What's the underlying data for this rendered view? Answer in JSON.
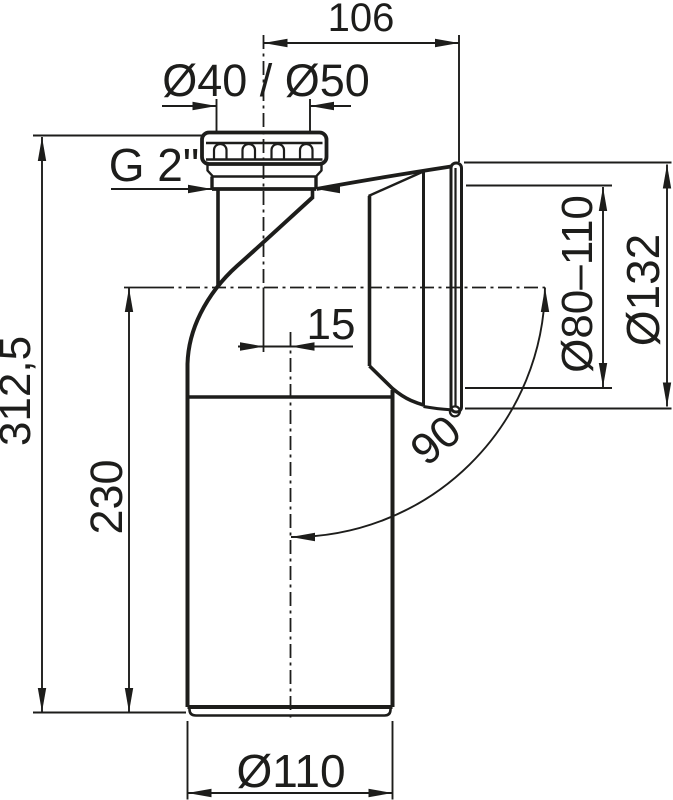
{
  "page": {
    "background": "#ffffff",
    "line_color": "#1d1d1b",
    "description": "Technical dimensional drawing of a 90-degree WC drain elbow connector"
  },
  "dimensions": {
    "top_width": "106",
    "inlet_diameter": "Ø40 / Ø50",
    "thread_size": "G 2\"",
    "center_offset": "15",
    "total_height": "312,5",
    "body_height": "230",
    "socket_inner_diameter": "Ø80–110",
    "socket_outer_diameter": "Ø132",
    "bend_angle": "90°",
    "outlet_diameter": "Ø110"
  }
}
